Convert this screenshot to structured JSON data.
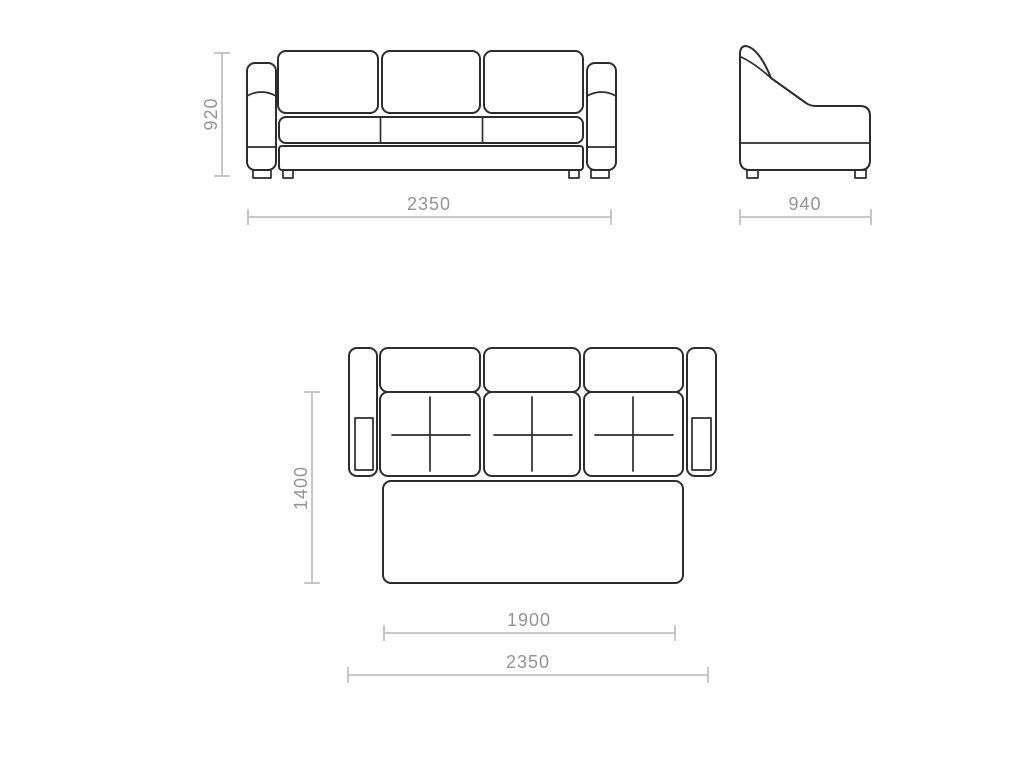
{
  "diagram": {
    "subject": "sofa-bed-technical-drawing",
    "colors": {
      "background": "#ffffff",
      "furniture_outline": "#2d2d2d",
      "dimension_line": "#b9b9b9",
      "dimension_text": "#949494"
    },
    "dims": {
      "front_height": "920",
      "front_width": "2350",
      "side_depth": "940",
      "plan_depth": "1400",
      "plan_bed_length": "1900",
      "plan_total_width": "2350"
    }
  }
}
